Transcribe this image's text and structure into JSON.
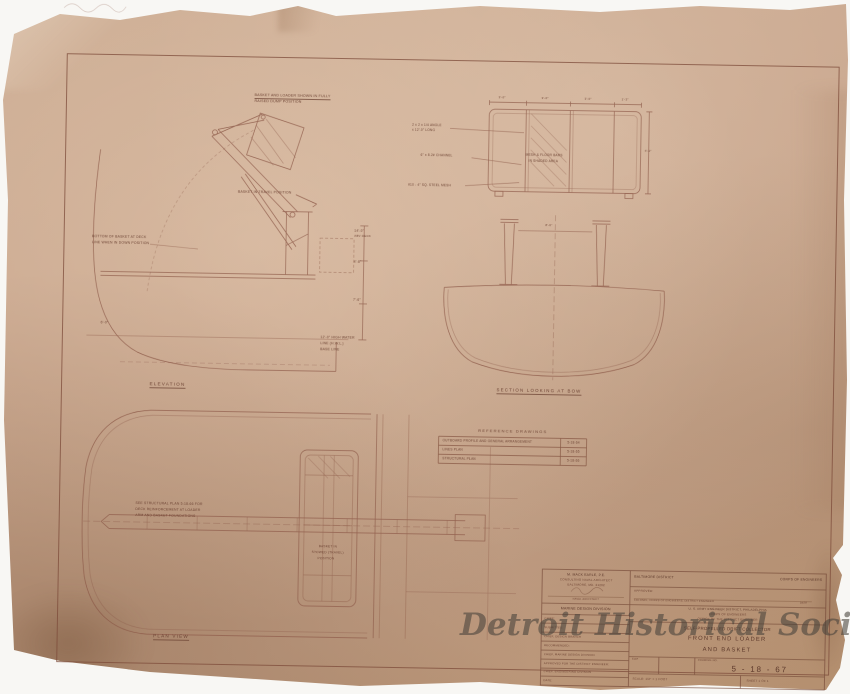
{
  "document": {
    "watermark": "Detroit Historical Society"
  },
  "palette": {
    "paper": "#c6a289",
    "ink": "#7c4b38",
    "watermark": "#46423b",
    "background": "#f6f4f1"
  },
  "views": {
    "elevation": {
      "label": "ELEVATION",
      "notes": {
        "top1": "BASKET AND LOADER SHOWN IN FULLY",
        "top2": "RAISED DUMP POSITION",
        "travel": "BASKET IN TRAVEL POSITION",
        "left1": "BOTTOM OF BASKET AT DECK",
        "left2": "LINE WHEN IN DOWN POSITION",
        "dim1a": "14'-0\"",
        "dim1b": "ABV DECK",
        "dim2": "4'-6\"",
        "dim3": "7'-6\"",
        "dim4": "6'-0\"",
        "hw1": "12'-0\" HIGH WATER",
        "hw2": "LINE (H.W.L.)",
        "hw3": "BASE LINE"
      }
    },
    "basket_detail": {
      "callout1a": "2 x 2 x 1/4 ANGLE",
      "callout1b": "x 12'-0\" LONG",
      "callout2": "6\" x 8.2# CHANNEL",
      "callout3": "#10 - 4\" SQ. STEEL MESH",
      "inside1": "MESH & FLOOR BARS",
      "inside2": "IN SHADED AREA",
      "dim_top1": "3'-0\"",
      "dim_top2": "3'-0\"",
      "dim_top3": "3'-0\"",
      "dim_top4": "1'-3\"",
      "dim_right": "4'-2\""
    },
    "section": {
      "label": "SECTION LOOKING AT BOW",
      "dim1": "8'-6\""
    },
    "plan": {
      "label": "PLAN VIEW",
      "note1": "SEE STRUCTURAL PLAN 5-18-66 FOR",
      "note2": "DECK REINFORCEMENT AT LOADER",
      "note3": "ARM AND BASKET FOUNDATIONS",
      "basket1": "BASKET IN",
      "basket2": "STOWED (TRAVEL)",
      "basket3": "POSITION"
    }
  },
  "reference_table": {
    "title": "REFERENCE  DRAWINGS",
    "rows": [
      {
        "name": "OUTBOARD PROFILE AND GENERAL ARRANGEMENT",
        "number": "5-18-64"
      },
      {
        "name": "LINES PLAN",
        "number": "5-18-65"
      },
      {
        "name": "STRUCTURAL PLAN",
        "number": "5-18-66"
      }
    ]
  },
  "title_block": {
    "architect_line1": "M. MACK EARLE, P.E.",
    "architect_line2": "CONSULTING NAVAL ARCHITECT",
    "architect_line3": "BALTIMORE, MD. 21202",
    "architect_role": "NAVAL ARCHITECT",
    "division": "MARINE DESIGN DIVISION",
    "approval_rows": [
      "CHIEF:",
      "SUBMITTED:",
      "CHIEF, DESIGN BRANCH",
      "RECOMMENDED:",
      "CHIEF, MARINE DESIGN DIVISION",
      "APPROVED FOR THE DISTRICT ENGINEER:",
      "CHIEF, ENGINEERING DIVISION",
      "DATE:"
    ],
    "district": "BALTIMORE DISTRICT",
    "corps": "CORPS OF ENGINEERS",
    "approved_label": "APPROVED:",
    "signature_caption": "COLONEL, CORPS OF ENGINEERS, DISTRICT ENGINEER",
    "signature_date": "DATE",
    "agency_line1": "U. S. ARMY ENGINEER DISTRICT, PHILADELPHIA",
    "agency_line2": "CORPS OF ENGINEERS",
    "agency_line3": "OFFICE OF THE DISTRICT ENGINEER",
    "project": "SELF-PROPELLED DRIFT COLLECTOR",
    "title_line1": "FRONT END LOADER",
    "title_line2": "AND BASKET",
    "size_label": "SIZE",
    "drawing_no_label": "DRAWING NO.",
    "drawing_no": "5 - 18 - 67",
    "scale": "SCALE: 1/2\" = 1 FOOT",
    "sheet": "SHEET 1 OF 1"
  }
}
